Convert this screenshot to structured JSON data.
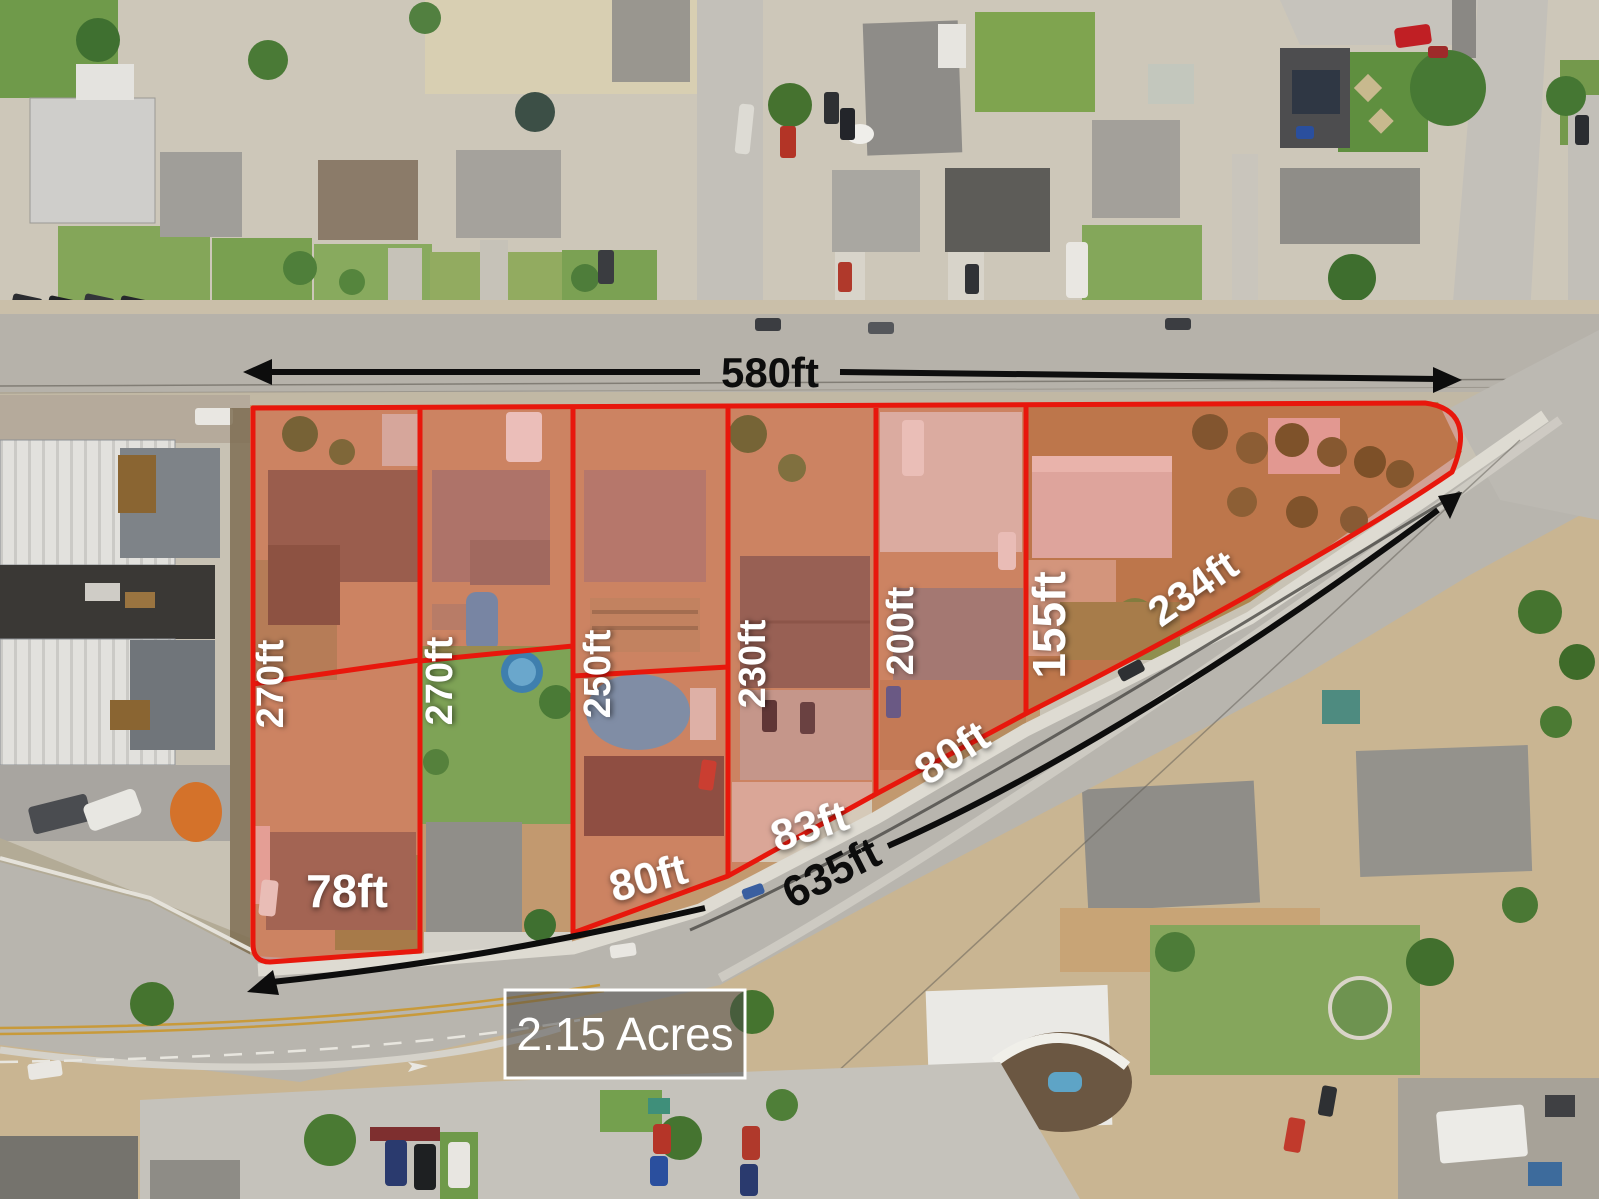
{
  "annotations": {
    "top_arrow_label": "580ft",
    "bottom_arrow_label": "635ft",
    "area_badge": "2.15 Acres",
    "curve_label": "234ft",
    "lot_depth_labels": [
      "270ft",
      "270ft",
      "250ft",
      "230ft",
      "200ft",
      "155ft"
    ],
    "frontage_labels": [
      "78ft",
      "80ft",
      "83ft",
      "80ft"
    ]
  },
  "colors": {
    "lot_boundary": "#e8170c",
    "lot_fill_tint": "rgba(233,75,62,0.27)",
    "measure_arrow": "#0d0d0d",
    "label_text": "#ffffff",
    "badge_fill": "rgba(72,72,72,0.52)",
    "badge_border": "#ffffff"
  }
}
